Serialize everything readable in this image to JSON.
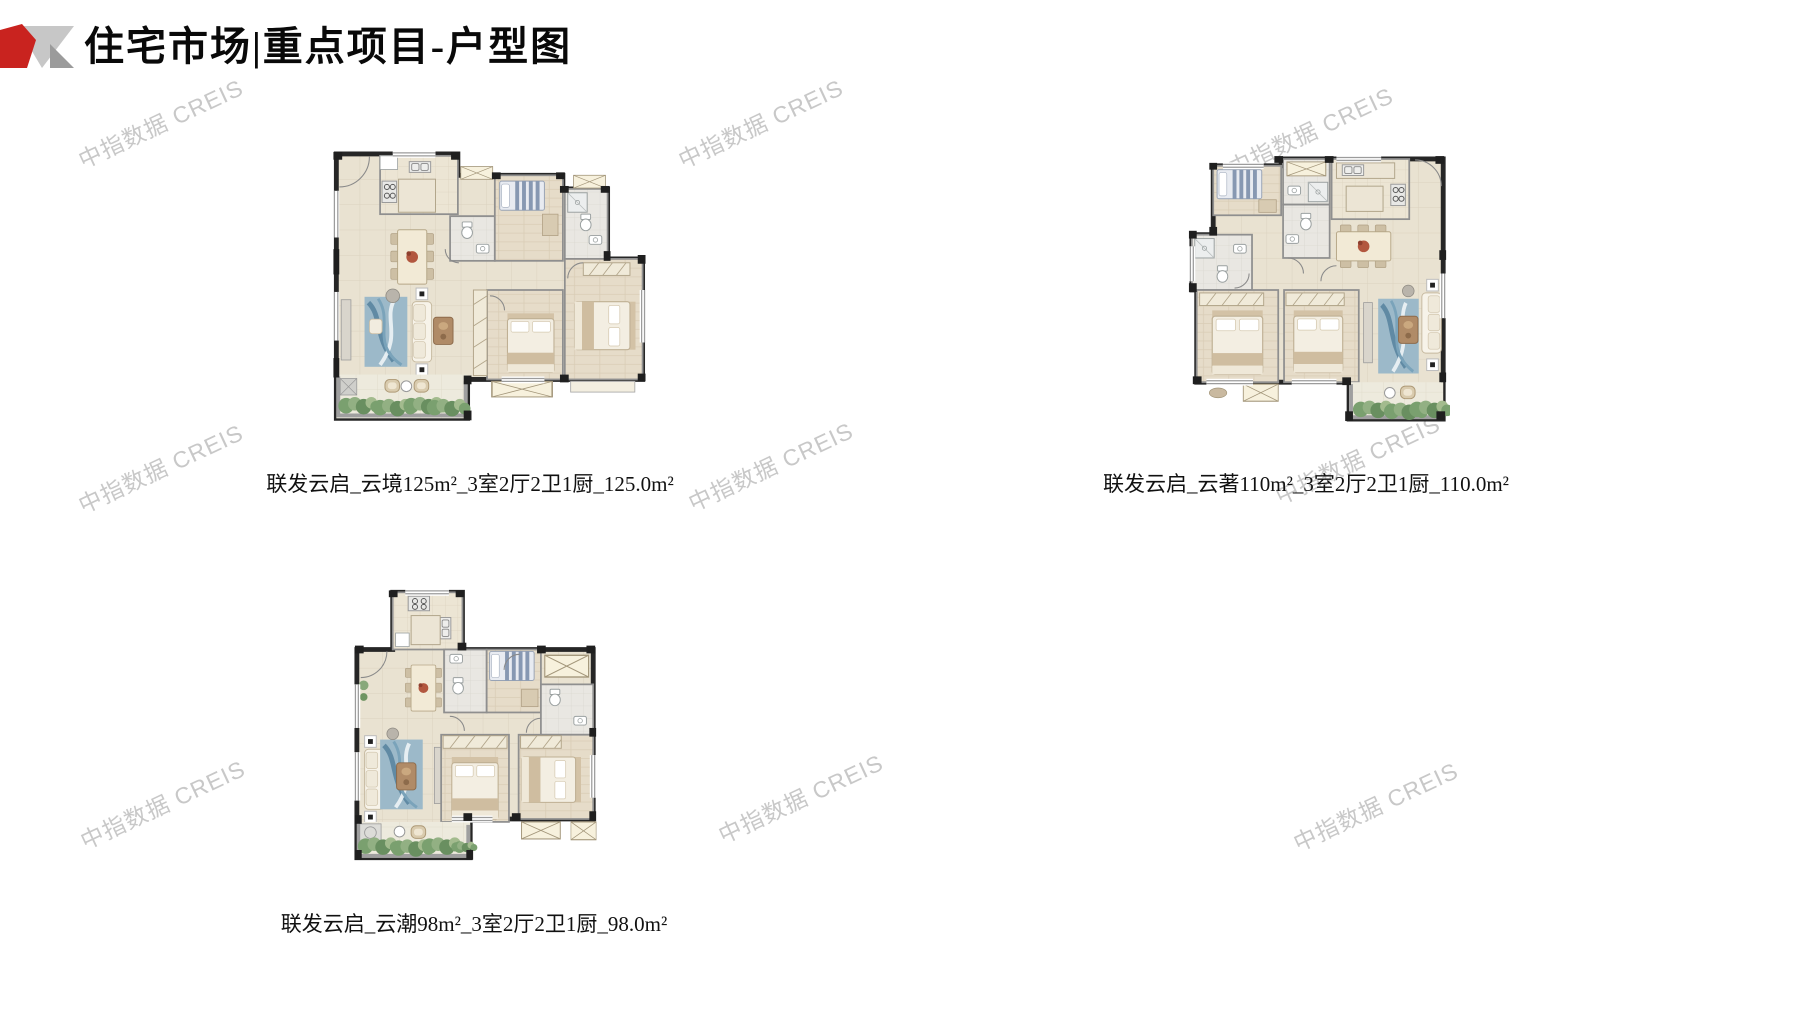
{
  "header": {
    "title": "住宅市场|重点项目-户型图"
  },
  "watermark": {
    "text": "中指数据 CREIS",
    "color": "#c8c8c8"
  },
  "plans": [
    {
      "id": "plan-125",
      "caption": "联发云启_云境125m²_3室2厅2卫1厨_125.0m²"
    },
    {
      "id": "plan-110",
      "caption": "联发云启_云著110m²_3室2厅2卫1厨_110.0m²"
    },
    {
      "id": "plan-98",
      "caption": "联发云启_云潮98m²_3室2厅2卫1厨_98.0m²"
    }
  ],
  "palette": {
    "brand_red": "#c9231f",
    "logo_gray_light": "#c7c7c7",
    "logo_gray_dark": "#9b9b9b",
    "wall_black": "#262626",
    "wall_gray": "#8f8f8f",
    "floor_beige": "#e9e2d1",
    "floor_wood": "#e6dcc9",
    "floor_bath": "#e9e7e2",
    "plant_green": "#7aa06f",
    "rug_blue": "#9cb9c9"
  }
}
